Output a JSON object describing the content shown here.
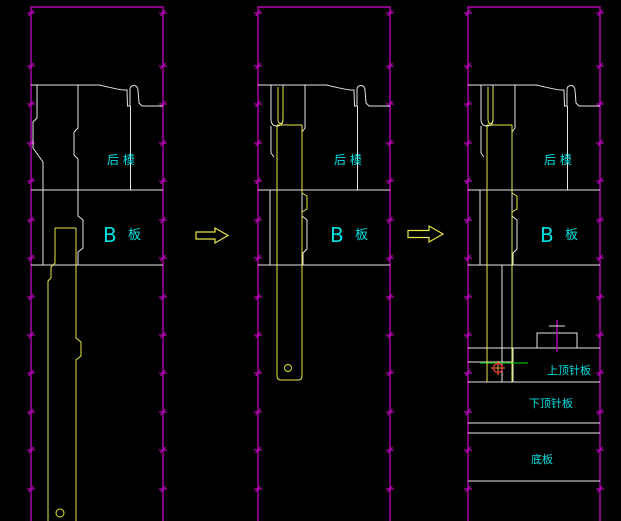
{
  "drawing": {
    "type": "mold-ejection-sequence",
    "stage_count": 3,
    "colors": {
      "background": "#000000",
      "section_border": "#b400b4",
      "mold_geometry": "#e6e6e6",
      "ejector_pin_highlight": "#e8e84a",
      "label_text": "#00e1e1",
      "datum_line_green": "#00b400",
      "point_marker_red": "#e03030"
    },
    "panels": [
      {
        "id": "stage-1",
        "labels": {
          "rear_mold": "后 模",
          "b_letter": "B",
          "b_plate": "板"
        }
      },
      {
        "id": "stage-2",
        "labels": {
          "rear_mold": "后 模",
          "b_letter": "B",
          "b_plate": "板"
        }
      },
      {
        "id": "stage-3",
        "labels": {
          "rear_mold": "后 模",
          "b_letter": "B",
          "b_plate": "板",
          "upper_ejector_plate": "上顶针板",
          "lower_ejector_plate": "下顶针板",
          "bottom_plate": "底板"
        }
      }
    ],
    "arrows": [
      {
        "icon": "right-arrow-icon"
      },
      {
        "icon": "right-arrow-icon"
      }
    ]
  }
}
